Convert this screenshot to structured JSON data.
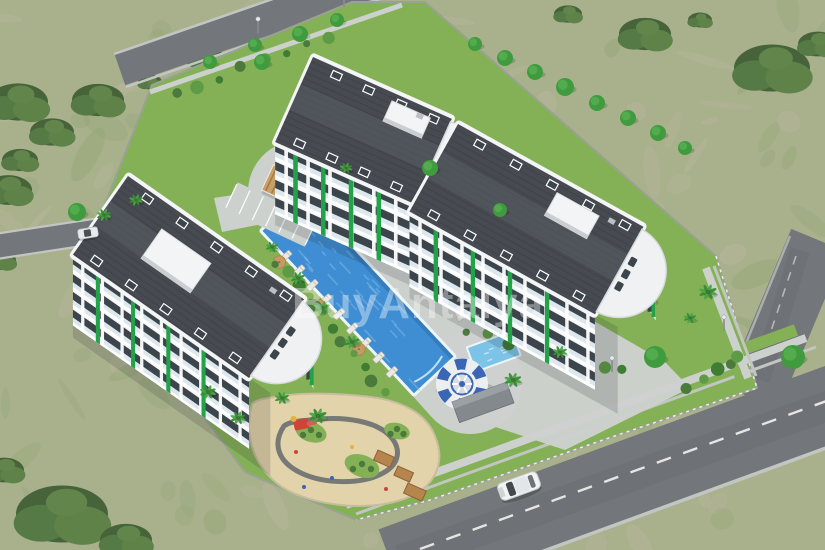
{
  "scene_type": "aerial-3d-architectural-render-of-residential-complex",
  "watermark": {
    "text": "BuyAntalya"
  },
  "palette": {
    "field": "#a9b08c",
    "field_beige": "#b8b79d",
    "field_green": "#95a878",
    "lawn": "#85b156",
    "pave": "#cdd1ce",
    "road": "#73767a",
    "curb": "#c2c6c3",
    "roof": "#474b51",
    "roof_light": "#5a6068",
    "facade": "#f4f6f7",
    "glass": "#3c444c",
    "accent": "#22a347",
    "pool": "#3f8ed3",
    "pool_light": "#8cc2ea",
    "kids_pool": "#7cc3e8",
    "sand": "#e3d3ab",
    "bush": "#46633a",
    "tree": "#3f9b3d",
    "palm": "#3e8f3e",
    "umbrella": "#c59a63",
    "wood": "#c89f66",
    "slide_blue": "#3a66b5",
    "slide_red": "#cf4438",
    "car": "#f2f4f4"
  },
  "objects": {
    "buildings": [
      "left-block",
      "top-block",
      "right-block"
    ],
    "amenities": [
      "swimming-pool",
      "kids-pool",
      "round-pool-bar",
      "gazebo",
      "pergola",
      "parking",
      "sun-loungers",
      "playground"
    ],
    "vehicles": [
      "white-car-on-road",
      "white-car-side-street"
    ]
  }
}
